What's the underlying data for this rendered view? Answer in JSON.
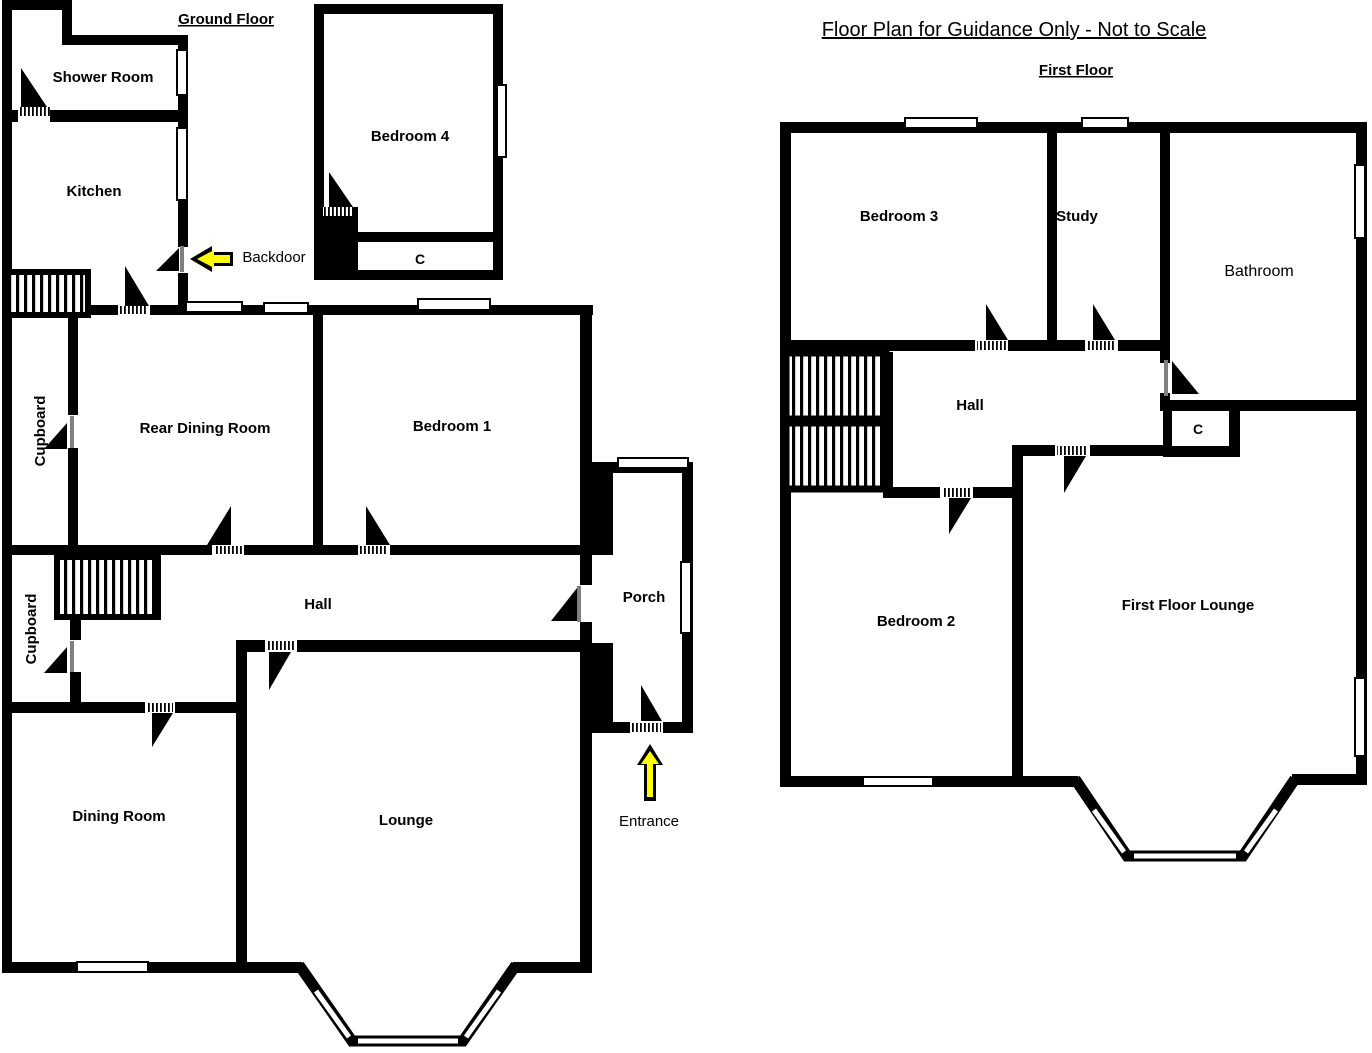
{
  "page_title": "Floor Plan for Guidance Only - Not to Scale",
  "colors": {
    "wall": "#000000",
    "background": "#ffffff",
    "arrow_fill": "#ffff00",
    "door_leaf": "#808080"
  },
  "ground_floor": {
    "heading": "Ground Floor",
    "rooms": {
      "shower_room": "Shower Room",
      "kitchen": "Kitchen",
      "bedroom4": "Bedroom 4",
      "bedroom4_cupboard": "C",
      "cupboard_upper": "Cupboard",
      "rear_dining_room": "Rear Dining Room",
      "bedroom1": "Bedroom 1",
      "hall": "Hall",
      "cupboard_lower": "Cupboard",
      "dining_room": "Dining Room",
      "lounge": "Lounge",
      "porch": "Porch"
    },
    "annotations": {
      "backdoor": "Backdoor",
      "entrance": "Entrance"
    }
  },
  "first_floor": {
    "heading": "First Floor",
    "rooms": {
      "bedroom3": "Bedroom 3",
      "study": "Study",
      "bathroom": "Bathroom",
      "hall": "Hall",
      "cupboard": "C",
      "bedroom2": "Bedroom 2",
      "lounge": "First Floor Lounge"
    }
  }
}
